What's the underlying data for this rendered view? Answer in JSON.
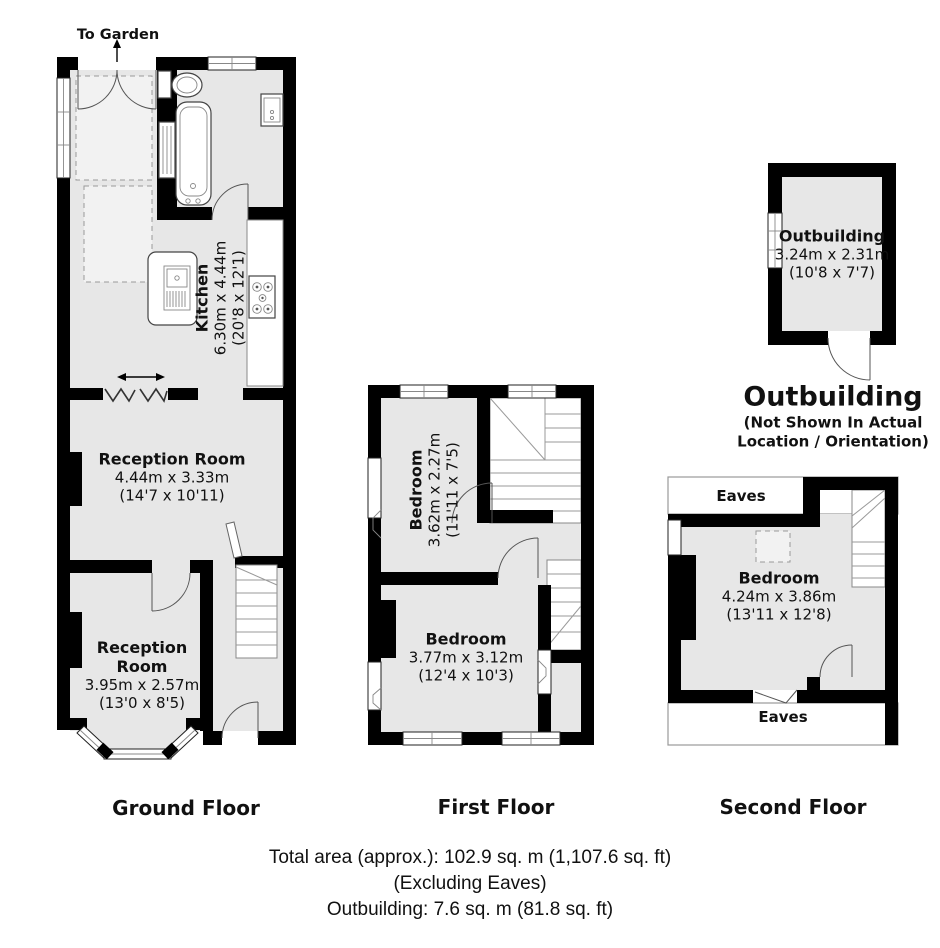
{
  "colors": {
    "wall": "#000000",
    "room_fill": "#e7e7e7",
    "light_fill": "#f2f2f2",
    "background": "#ffffff"
  },
  "ground_floor": {
    "floor_label": "Ground Floor",
    "to_garden_label": "To Garden",
    "kitchen": {
      "name": "Kitchen",
      "dims_metric": "6.30m x 4.44m",
      "dims_imperial": "(20'8 x 12'1)"
    },
    "reception_room_1": {
      "name": "Reception Room",
      "dims_metric": "4.44m x 3.33m",
      "dims_imperial": "(14'7 x 10'11)"
    },
    "reception_room_2": {
      "name": "Reception Room",
      "dims_metric": "3.95m x 2.57m",
      "dims_imperial": "(13'0 x 8'5)"
    }
  },
  "first_floor": {
    "floor_label": "First Floor",
    "bedroom_1": {
      "name": "Bedroom",
      "dims_metric": "3.62m x 2.27m",
      "dims_imperial": "(11'11 x 7'5)"
    },
    "bedroom_2": {
      "name": "Bedroom",
      "dims_metric": "3.77m x 3.12m",
      "dims_imperial": "(12'4 x 10'3)"
    }
  },
  "second_floor": {
    "floor_label": "Second Floor",
    "eaves_top_label": "Eaves",
    "eaves_bottom_label": "Eaves",
    "bedroom": {
      "name": "Bedroom",
      "dims_metric": "4.24m x 3.86m",
      "dims_imperial": "(13'11 x 12'8)"
    }
  },
  "outbuilding": {
    "room": {
      "name": "Outbuilding",
      "dims_metric": "3.24m x 2.31m",
      "dims_imperial": "(10'8 x 7'7)"
    },
    "section_label": "Outbuilding",
    "note_line_1": "(Not Shown In Actual",
    "note_line_2": "Location / Orientation)"
  },
  "summary": {
    "total_area": "Total area (approx.): 102.9 sq. m (1,107.6 sq. ft)",
    "excluding": "(Excluding Eaves)",
    "outbuilding_area": "Outbuilding: 7.6 sq. m (81.8 sq. ft)"
  }
}
